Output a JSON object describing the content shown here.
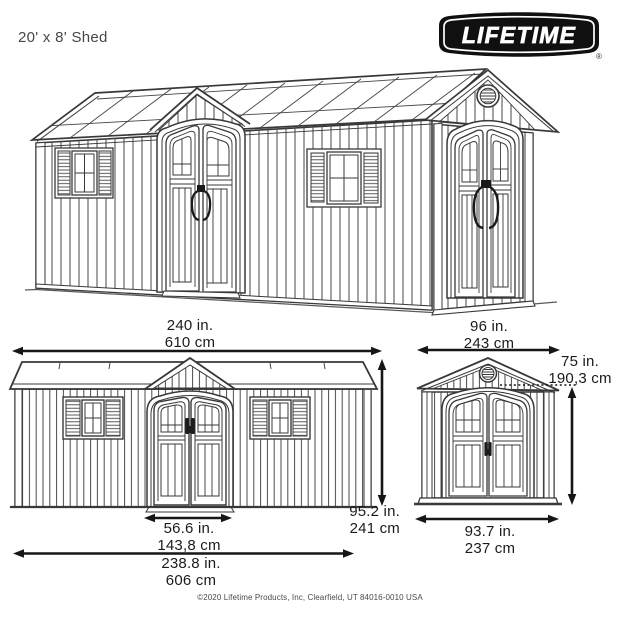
{
  "page": {
    "title": "20' x 8' Shed"
  },
  "logo": {
    "text": "LIFETIME",
    "registered_mark": "®"
  },
  "dimensions": {
    "front_width_in": "240 in.",
    "front_width_cm": "610 cm",
    "side_width_in": "96 in.",
    "side_width_cm": "243 cm",
    "door_height_in": "75 in.",
    "door_height_cm": "190,3 cm",
    "wall_height_in": "95.2 in.",
    "wall_height_cm": "241 cm",
    "door_width_in": "56.6 in.",
    "door_width_cm": "143,8 cm",
    "base_width_in": "238.8 in.",
    "base_width_cm": "606 cm",
    "side_base_width_in": "93.7 in.",
    "side_base_width_cm": "237 cm"
  },
  "footer": {
    "copyright": "©2020 Lifetime Products, Inc, Clearfield, UT 84016-0010 USA"
  },
  "colors": {
    "line": "#3a3a3a",
    "text": "#1b1b1b",
    "logo_bg": "#101010",
    "arrow": "#161616"
  }
}
